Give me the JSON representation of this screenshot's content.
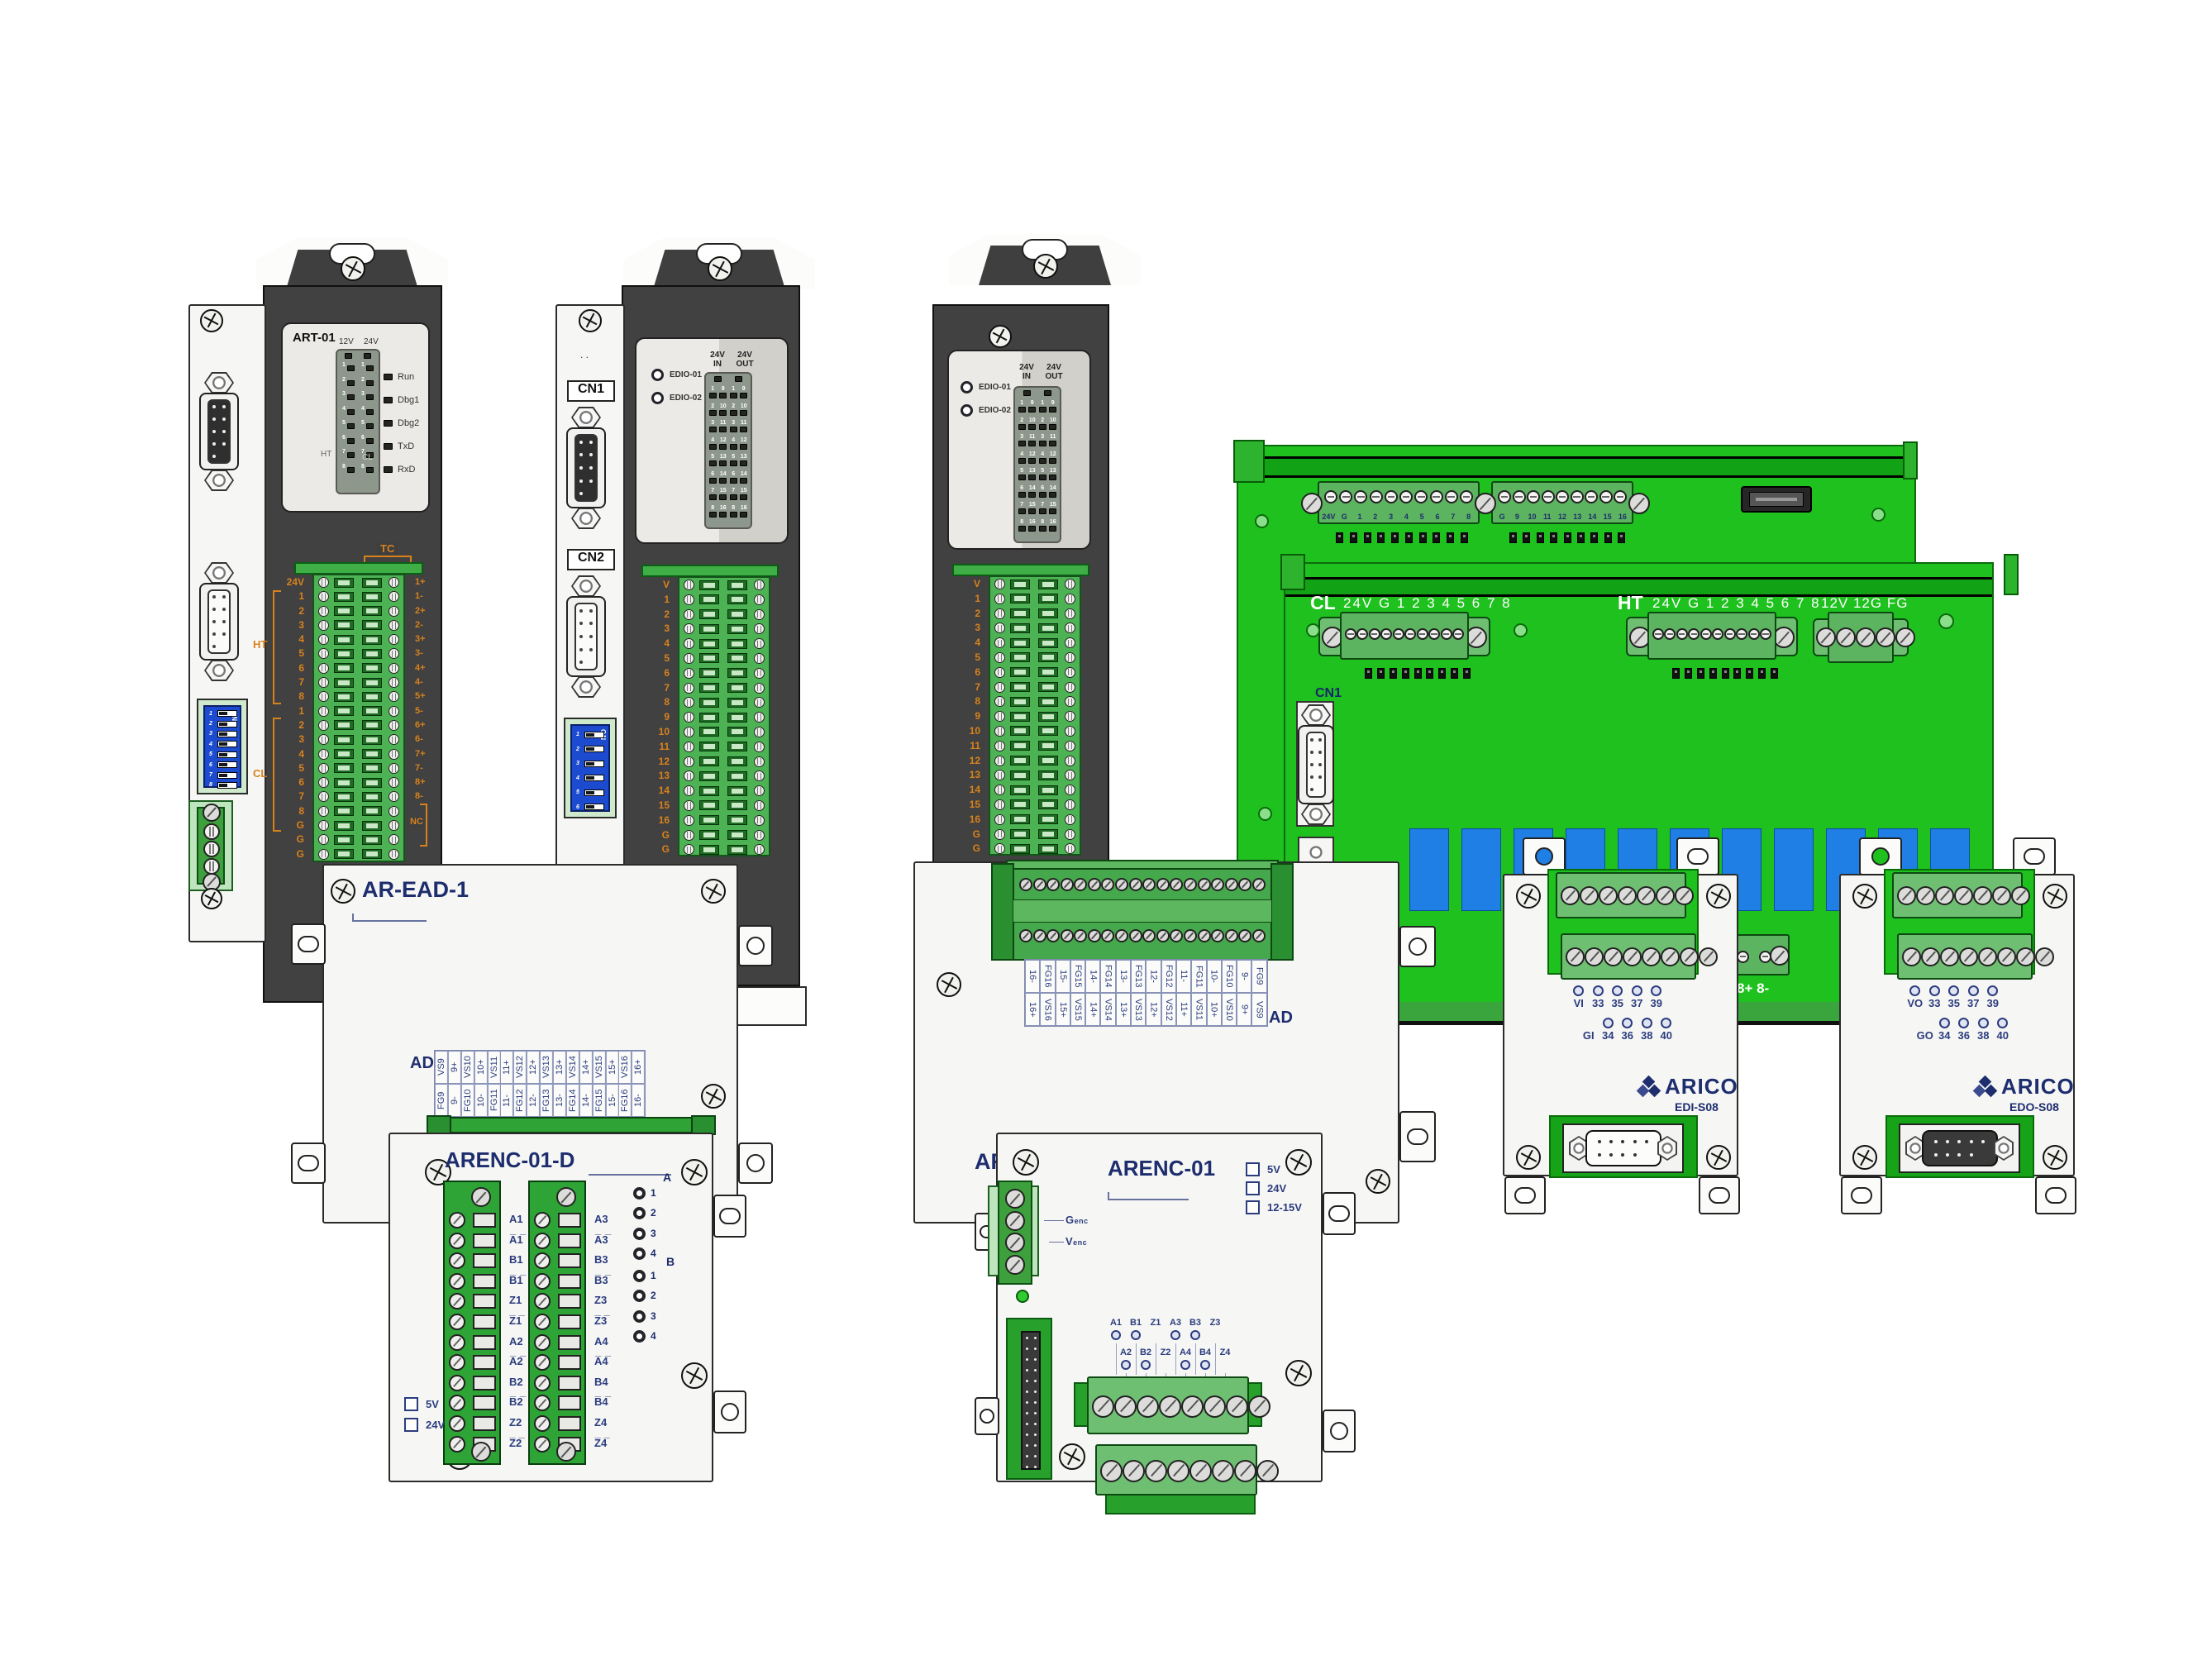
{
  "colors": {
    "pcb_green": "#1fc11f",
    "terminal_green": "#4db253",
    "relay_blue": "#1f7fe4",
    "dip_blue": "#1d4bd0",
    "label_orange": "#d8821c",
    "label_navy": "#1d2d6e",
    "module_dark": "#414141"
  },
  "art01": {
    "title": "ART-01",
    "volt12": "12V",
    "volt24": "24V",
    "rows": [
      "1",
      "2",
      "3",
      "4",
      "5",
      "6",
      "7",
      "8"
    ],
    "status": [
      "Run",
      "Dbg1",
      "Dbg2",
      "TxD",
      "RxD"
    ],
    "ht": "HT",
    "cl": "CL",
    "tc": "TC",
    "nc": "NC",
    "left_labels": [
      "24V",
      "1",
      "2",
      "3",
      "4",
      "5",
      "6",
      "7",
      "8",
      "1",
      "2",
      "3",
      "4",
      "5",
      "6",
      "7",
      "8",
      "G",
      "G",
      "G"
    ],
    "right_labels": [
      "1+",
      "1-",
      "2+",
      "2-",
      "3+",
      "3-",
      "4+",
      "4-",
      "5+",
      "5-",
      "6+",
      "6-",
      "7+",
      "7-",
      "8+",
      "8-"
    ],
    "dip": [
      "1",
      "2",
      "3",
      "4",
      "5",
      "6",
      "7",
      "8"
    ],
    "dip_on": "ON"
  },
  "edio": {
    "led1": "EDIO-01",
    "led2": "EDIO-02",
    "hdr24": "24V",
    "in": "IN",
    "out": "OUT",
    "grid": [
      {
        "a": "1",
        "b": "9"
      },
      {
        "a": "2",
        "b": "10"
      },
      {
        "a": "3",
        "b": "11"
      },
      {
        "a": "4",
        "b": "12"
      },
      {
        "a": "5",
        "b": "13"
      },
      {
        "a": "6",
        "b": "14"
      },
      {
        "a": "7",
        "b": "15"
      },
      {
        "a": "8",
        "b": "16"
      }
    ],
    "rows": [
      "V",
      "1",
      "2",
      "3",
      "4",
      "5",
      "6",
      "7",
      "8",
      "9",
      "10",
      "11",
      "12",
      "13",
      "14",
      "15",
      "16",
      "G",
      "G"
    ],
    "cn1": "CN1",
    "cn2": "CN2",
    "dots": ". .",
    "dip": [
      "1",
      "2",
      "3",
      "4",
      "5",
      "6"
    ],
    "dip_on": "ON"
  },
  "backboard": {
    "tb1": [
      "24V",
      "G",
      "1",
      "2",
      "3",
      "4",
      "5",
      "6",
      "7",
      "8"
    ],
    "tb2": [
      "G",
      "9",
      "10",
      "11",
      "12",
      "13",
      "14",
      "15",
      "16"
    ]
  },
  "frontboard": {
    "cl": "CL",
    "ht": "HT",
    "pins": "24V G 1 2 3 4 5 6 7 8",
    "aux": "12V 12G FG",
    "cn1": "CN1",
    "pin8": "8+ 8-"
  },
  "aread": {
    "title": "AR-EAD-1",
    "title_partial": "AR-",
    "ad": "AD",
    "top": [
      "VS9",
      "9+",
      "VS10",
      "10+",
      "VS11",
      "11+",
      "VS12",
      "12+",
      "VS13",
      "13+",
      "VS14",
      "14+",
      "VS15",
      "15+",
      "VS16",
      "16+"
    ],
    "bottom": [
      "FG9",
      "9-",
      "FG10",
      "10-",
      "FG11",
      "11-",
      "FG12",
      "12-",
      "FG13",
      "13-",
      "FG14",
      "14-",
      "FG15",
      "15-",
      "FG16",
      "16-"
    ],
    "top_rev": [
      "16-",
      "FG16",
      "15-",
      "FG15",
      "14-",
      "FG14",
      "13-",
      "FG13",
      "12-",
      "FG12",
      "11-",
      "FG11",
      "10-",
      "FG10",
      "9-",
      "FG9"
    ],
    "bottom_rev": [
      "16+",
      "VS16",
      "15+",
      "VS15",
      "14+",
      "VS14",
      "13+",
      "VS13",
      "12+",
      "VS12",
      "11+",
      "VS11",
      "10+",
      "VS10",
      "9+",
      "VS9"
    ]
  },
  "arencd": {
    "title": "ARENC-01-D",
    "tb1": [
      "A1",
      "A̅1̅",
      "B1",
      "B̅1̅",
      "Z1",
      "Z̅1̅",
      "A2",
      "A̅2̅",
      "B2",
      "B̅2̅",
      "Z2",
      "Z̅2̅"
    ],
    "tb2": [
      "A3",
      "A̅3̅",
      "B3",
      "B̅3̅",
      "Z3",
      "Z̅3̅",
      "A4",
      "A̅4̅",
      "B4",
      "B̅4̅",
      "Z4",
      "Z̅4̅"
    ],
    "grpA": "A",
    "grpB": "B",
    "lednums": [
      "1",
      "2",
      "3",
      "4"
    ],
    "cb": [
      "5V",
      "24V"
    ]
  },
  "arenc": {
    "title": "ARENC-01",
    "cb": [
      "5V",
      "24V",
      "12-15V"
    ],
    "genc": "Genc",
    "venc": "Venc",
    "sig1": [
      {
        "t": "A1",
        "c": "1"
      },
      {
        "t": "B1",
        "c": "1"
      },
      {
        "t": "Z1",
        "c": "0"
      },
      {
        "t": "A3",
        "c": "1"
      },
      {
        "t": "B3",
        "c": "1"
      },
      {
        "t": "Z3",
        "c": "0"
      }
    ],
    "sig2": [
      {
        "t": "A2",
        "c": "1"
      },
      {
        "t": "B2",
        "c": "1"
      },
      {
        "t": "Z2",
        "c": "0"
      },
      {
        "t": "A4",
        "c": "1"
      },
      {
        "t": "B4",
        "c": "1"
      },
      {
        "t": "Z4",
        "c": "0"
      }
    ]
  },
  "edi": {
    "brand": "ARICO",
    "model": "EDI-S08",
    "r1": [
      {
        "t": "VI",
        "c": "1"
      },
      {
        "t": "33",
        "c": "1"
      },
      {
        "t": "35",
        "c": "1"
      },
      {
        "t": "37",
        "c": "1"
      },
      {
        "t": "39",
        "c": "1"
      }
    ],
    "r2": [
      {
        "t": "GI",
        "c": "0"
      },
      {
        "t": "34",
        "c": "1"
      },
      {
        "t": "36",
        "c": "1"
      },
      {
        "t": "38",
        "c": "1"
      },
      {
        "t": "40",
        "c": "1"
      }
    ]
  },
  "edo": {
    "brand": "ARICO",
    "model": "EDO-S08",
    "r1": [
      {
        "t": "VO",
        "c": "1"
      },
      {
        "t": "33",
        "c": "1"
      },
      {
        "t": "35",
        "c": "1"
      },
      {
        "t": "37",
        "c": "1"
      },
      {
        "t": "39",
        "c": "1"
      }
    ],
    "r2": [
      {
        "t": "GO",
        "c": "0"
      },
      {
        "t": "34",
        "c": "1"
      },
      {
        "t": "36",
        "c": "1"
      },
      {
        "t": "38",
        "c": "1"
      },
      {
        "t": "40",
        "c": "1"
      }
    ]
  }
}
